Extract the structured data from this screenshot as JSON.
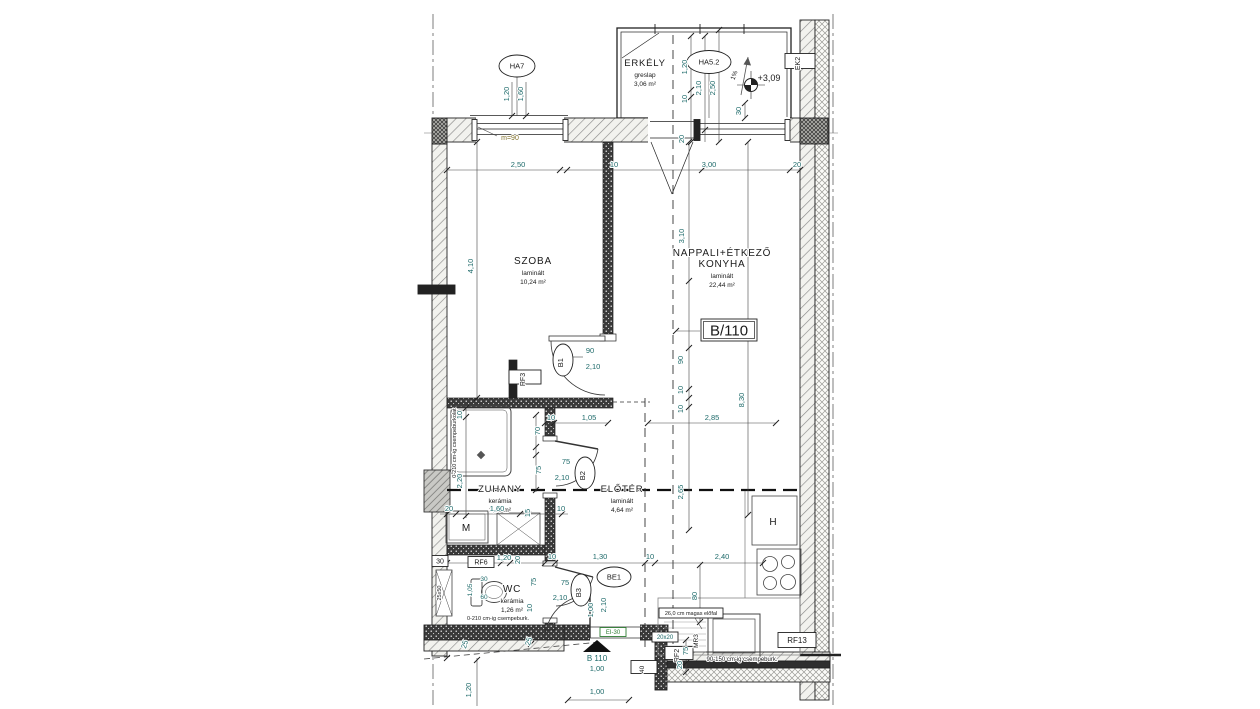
{
  "colors": {
    "dim": "#1f6b6b",
    "blk": "#1a1a1a",
    "green": "#2e7d32",
    "olv": "#80702a"
  },
  "unit_box": "B/110",
  "rooms": [
    {
      "lines": [
        "ERKÉLY"
      ],
      "finish": "greslap",
      "area": "3,06 m²",
      "x": 645,
      "y": 66,
      "ns": 9.5
    },
    {
      "lines": [
        "SZOBA"
      ],
      "finish": "laminált",
      "area": "10,24 m²",
      "x": 533,
      "y": 264,
      "ns": 10
    },
    {
      "lines": [
        "NAPPALI+ÉTKEZŐ",
        "KONYHA"
      ],
      "finish": "laminált",
      "area": "22,44 m²",
      "x": 722,
      "y": 256,
      "ns": 10
    },
    {
      "lines": [
        "ZUHANY"
      ],
      "finish": "kerámia",
      "area": "3,49 m²",
      "x": 500,
      "y": 492,
      "ns": 9.5
    },
    {
      "lines": [
        "ELŐTÉR"
      ],
      "finish": "laminált",
      "area": "4,64 m²",
      "x": 622,
      "y": 492,
      "ns": 9.5
    },
    {
      "lines": [
        "WC"
      ],
      "finish": "kerámia",
      "area": "1,26 m²",
      "x": 512,
      "y": 592,
      "ns": 10
    }
  ],
  "markers": [
    {
      "t": "HA7",
      "x": 517,
      "y": 66,
      "rx": 18,
      "ry": 11,
      "tr": 0
    },
    {
      "t": "HA5.2",
      "x": 709,
      "y": 62,
      "rx": 22,
      "ry": 11.5,
      "tr": 0
    },
    {
      "t": "B1",
      "x": 563,
      "y": 360,
      "rx": 10,
      "ry": 16,
      "tr": -90
    },
    {
      "t": "B2",
      "x": 585,
      "y": 473,
      "rx": 10,
      "ry": 16,
      "tr": -90
    },
    {
      "t": "B3",
      "x": 581,
      "y": 590,
      "rx": 10,
      "ry": 16,
      "tr": -90
    },
    {
      "t": "BE1",
      "x": 614,
      "y": 577,
      "rx": 17,
      "ry": 10,
      "tr": 0
    }
  ],
  "boxes": [
    {
      "t": "EK2",
      "x": 800,
      "y": 61,
      "w": 15,
      "h": 30,
      "r": -90,
      "fs": 7
    },
    {
      "t": "RF3",
      "x": 525,
      "y": 377,
      "w": 14,
      "h": 32,
      "r": -90,
      "fs": 7
    },
    {
      "t": "RF6",
      "x": 481,
      "y": 562,
      "w": 26,
      "h": 11,
      "r": 0,
      "fs": 7
    },
    {
      "t": "30",
      "x": 440,
      "y": 561,
      "w": 16,
      "h": 11,
      "r": 0,
      "fs": 7
    },
    {
      "t": "RF2",
      "x": 679,
      "y": 653,
      "w": 13,
      "h": 28,
      "r": -90,
      "fs": 7
    },
    {
      "t": "20x20",
      "x": 665,
      "y": 637,
      "w": 26,
      "h": 10,
      "r": 0,
      "fs": 6,
      "c": "dim"
    },
    {
      "t": "RF13",
      "x": 797,
      "y": 640,
      "w": 38,
      "h": 15,
      "r": 0,
      "fs": 8
    },
    {
      "t": "40",
      "x": 644,
      "y": 667,
      "w": 13,
      "h": 26,
      "r": -90,
      "fs": 6.5
    },
    {
      "t": "EI-30",
      "x": 613,
      "y": 632,
      "w": 26,
      "h": 9,
      "r": 0,
      "fs": 6,
      "c": "green"
    },
    {
      "t": "26,0 cm magas előfal",
      "x": 691,
      "y": 613,
      "w": 64,
      "h": 10,
      "r": 0,
      "fs": 5.5
    },
    {
      "t": "B/110",
      "x": 729,
      "y": 330,
      "w": 56,
      "h": 22,
      "r": 0,
      "fs": 15,
      "double": true
    }
  ],
  "labels": [
    {
      "t": "2,50",
      "x": 518,
      "y": 167
    },
    {
      "t": "10",
      "x": 614,
      "y": 167
    },
    {
      "t": "3,00",
      "x": 709,
      "y": 167
    },
    {
      "t": "20",
      "x": 797,
      "y": 167
    },
    {
      "t": "m=90",
      "x": 510,
      "y": 140,
      "c": "olv",
      "s": 7
    },
    {
      "t": "1,20",
      "x": 509,
      "y": 94,
      "r": -90
    },
    {
      "t": "1,60",
      "x": 523,
      "y": 94,
      "r": -90
    },
    {
      "t": "1,20",
      "x": 687,
      "y": 67,
      "r": -90
    },
    {
      "t": "10",
      "x": 687,
      "y": 99,
      "r": -90
    },
    {
      "t": "2,10",
      "x": 701,
      "y": 88,
      "r": -90
    },
    {
      "t": "2,50",
      "x": 715,
      "y": 88,
      "r": -90
    },
    {
      "t": "30",
      "x": 741,
      "y": 111,
      "r": -90
    },
    {
      "t": "20",
      "x": 684,
      "y": 139,
      "r": -90
    },
    {
      "t": "1%",
      "x": 736,
      "y": 76,
      "r": -70,
      "s": 6.5,
      "c": "blk"
    },
    {
      "t": "+3,09",
      "x": 769,
      "y": 81,
      "s": 9,
      "c": "blk"
    },
    {
      "t": "4,10",
      "x": 473,
      "y": 266,
      "r": -90
    },
    {
      "t": "3,10",
      "x": 684,
      "y": 236,
      "r": -90
    },
    {
      "t": "90",
      "x": 590,
      "y": 353
    },
    {
      "t": "2,10",
      "x": 593,
      "y": 369
    },
    {
      "t": "90",
      "x": 683,
      "y": 360,
      "r": -90
    },
    {
      "t": "10",
      "x": 683,
      "y": 390,
      "r": -90
    },
    {
      "t": "10",
      "x": 683,
      "y": 409,
      "r": -90
    },
    {
      "t": "8,30",
      "x": 744,
      "y": 400,
      "r": -90
    },
    {
      "t": "10",
      "x": 551,
      "y": 420
    },
    {
      "t": "1,05",
      "x": 589,
      "y": 420
    },
    {
      "t": "2,85",
      "x": 712,
      "y": 420
    },
    {
      "t": "2,65",
      "x": 683,
      "y": 492,
      "r": -90
    },
    {
      "t": "10",
      "x": 462,
      "y": 415,
      "r": -90
    },
    {
      "t": "2,20",
      "x": 462,
      "y": 481,
      "r": -90
    },
    {
      "t": "70",
      "x": 540,
      "y": 431,
      "r": -90
    },
    {
      "t": "75",
      "x": 541,
      "y": 470,
      "r": -90
    },
    {
      "t": "20",
      "x": 449,
      "y": 511
    },
    {
      "t": "1,60",
      "x": 497,
      "y": 511
    },
    {
      "t": "15",
      "x": 530,
      "y": 513,
      "r": -90
    },
    {
      "t": "10",
      "x": 561,
      "y": 511
    },
    {
      "t": "1,20",
      "x": 504,
      "y": 560
    },
    {
      "t": "20",
      "x": 520,
      "y": 560,
      "r": -90
    },
    {
      "t": "1,05",
      "x": 472,
      "y": 590,
      "r": -90,
      "s": 6.5
    },
    {
      "t": "30",
      "x": 484,
      "y": 581,
      "s": 6.5
    },
    {
      "t": "60",
      "x": 484,
      "y": 599,
      "s": 6.5
    },
    {
      "t": "75",
      "x": 536,
      "y": 582,
      "r": -90
    },
    {
      "t": "10",
      "x": 532,
      "y": 608,
      "r": -90
    },
    {
      "t": "75",
      "x": 565,
      "y": 585
    },
    {
      "t": "2,10",
      "x": 560,
      "y": 600
    },
    {
      "t": "75",
      "x": 566,
      "y": 464
    },
    {
      "t": "2,10",
      "x": 562,
      "y": 480
    },
    {
      "t": "1,30",
      "x": 600,
      "y": 559
    },
    {
      "t": "10",
      "x": 552,
      "y": 559
    },
    {
      "t": "10",
      "x": 650,
      "y": 559
    },
    {
      "t": "2,40",
      "x": 722,
      "y": 559
    },
    {
      "t": "1,00",
      "x": 593,
      "y": 610,
      "r": -90
    },
    {
      "t": "2,10",
      "x": 606,
      "y": 605,
      "r": -90
    },
    {
      "t": "80",
      "x": 697,
      "y": 596,
      "r": -90
    },
    {
      "t": "75",
      "x": 688,
      "y": 651,
      "r": -90
    },
    {
      "t": "20",
      "x": 682,
      "y": 665,
      "r": -90
    },
    {
      "t": "MR3",
      "x": 698,
      "y": 641,
      "r": -90,
      "c": "blk",
      "s": 6.5
    },
    {
      "t": "25x50",
      "x": 441,
      "y": 593,
      "r": -90,
      "c": "blk",
      "s": 5.5
    },
    {
      "t": "25",
      "x": 467,
      "y": 645,
      "r": -75
    },
    {
      "t": "25",
      "x": 531,
      "y": 642,
      "r": -75
    },
    {
      "t": "1,20",
      "x": 471,
      "y": 690,
      "r": -90
    },
    {
      "t": "B 110",
      "x": 597,
      "y": 661,
      "s": 8
    },
    {
      "t": "1,00",
      "x": 597,
      "y": 671
    },
    {
      "t": "1,00",
      "x": 597,
      "y": 694
    },
    {
      "t": "0-210 cm-ig csempeburkolat",
      "x": 456,
      "y": 443,
      "r": -90,
      "c": "blk",
      "s": 5.5
    },
    {
      "t": "0-210 cm-ig csempeburk.",
      "x": 498,
      "y": 620,
      "c": "blk",
      "s": 5.5
    },
    {
      "t": "90-150 cm-ig csempeburk.",
      "x": 742,
      "y": 661,
      "c": "blk",
      "s": 6
    },
    {
      "t": "M",
      "x": 466,
      "y": 531,
      "c": "blk",
      "s": 10
    },
    {
      "t": "H",
      "x": 773,
      "y": 525,
      "c": "blk",
      "s": 10
    }
  ]
}
